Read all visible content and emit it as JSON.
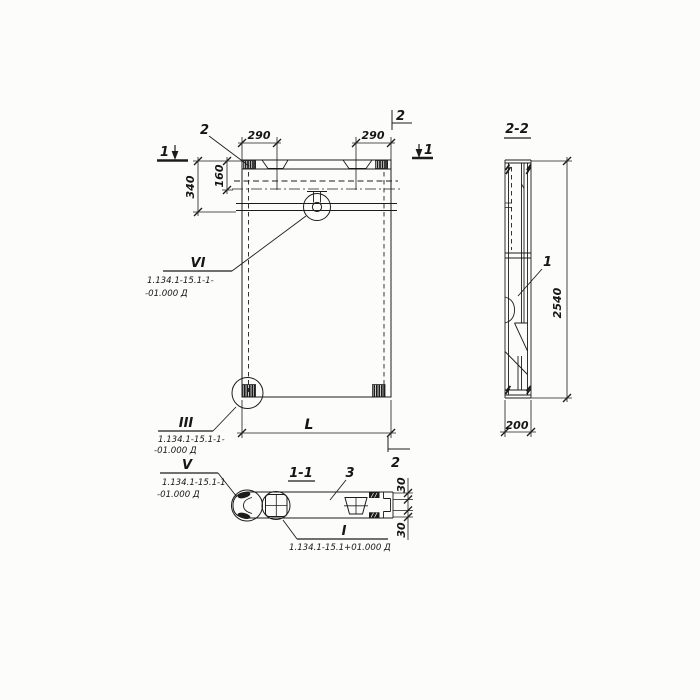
{
  "front": {
    "cut1": "1",
    "cut2": "2",
    "callout_plate": "2",
    "dim_290_left": "290",
    "dim_290_right": "290",
    "dim_340": "340",
    "dim_160": "160",
    "dim_length": "L",
    "detail_vi": {
      "num": "VI",
      "ref1": "1.134.1-15.1-1-",
      "ref2": "-01.000 Д"
    },
    "detail_iii": {
      "num": "III",
      "ref1": "1.134.1-15.1-1-",
      "ref2": "-01.000 Д"
    }
  },
  "sec11": {
    "title": "1-1",
    "item3": "3",
    "dim_30_top": "30",
    "dim_30_bottom": "30",
    "detail_v": {
      "num": "V",
      "ref1": "1.134.1-15.1-1",
      "ref2": "-01.000 Д"
    },
    "detail_i": {
      "num": "I",
      "ref1": "1.134.1-15.1+01.000 Д"
    }
  },
  "sec22": {
    "title": "2-2",
    "item1": "1",
    "dim_2540": "2540",
    "dim_200": "200"
  }
}
